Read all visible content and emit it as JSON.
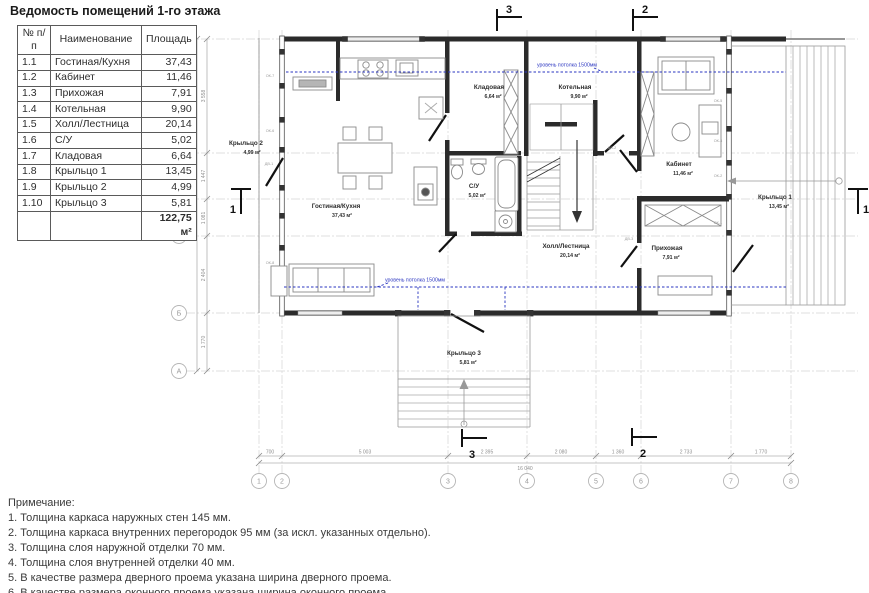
{
  "schedule": {
    "title": "Ведомость помещений 1-го этажа",
    "headers": {
      "num": "№ п/п",
      "name": "Наименование",
      "area": "Площадь"
    },
    "rows": [
      {
        "num": "1.1",
        "name": "Гостиная/Кухня",
        "area": "37,43"
      },
      {
        "num": "1.2",
        "name": "Кабинет",
        "area": "11,46"
      },
      {
        "num": "1.3",
        "name": "Прихожая",
        "area": "7,91"
      },
      {
        "num": "1.4",
        "name": "Котельная",
        "area": "9,90"
      },
      {
        "num": "1.5",
        "name": "Холл/Лестница",
        "area": "20,14"
      },
      {
        "num": "1.6",
        "name": "С/У",
        "area": "5,02"
      },
      {
        "num": "1.7",
        "name": "Кладовая",
        "area": "6,64"
      },
      {
        "num": "1.8",
        "name": "Крыльцо 1",
        "area": "13,45"
      },
      {
        "num": "1.9",
        "name": "Крыльцо 2",
        "area": "4,99"
      },
      {
        "num": "1.10",
        "name": "Крыльцо 3",
        "area": "5,81"
      }
    ],
    "total": "122,75 м²"
  },
  "plan": {
    "rooms": {
      "living": {
        "name": "Гостиная/Кухня",
        "area": "37,43 м²"
      },
      "storage": {
        "name": "Кладовая",
        "area": "6,64 м²"
      },
      "boiler": {
        "name": "Котельная",
        "area": "9,90 м²"
      },
      "wc": {
        "name": "С/У",
        "area": "5,02 м²"
      },
      "hall": {
        "name": "Холл/Лестница",
        "area": "20,14 м²"
      },
      "cabinet": {
        "name": "Кабинет",
        "area": "11,46 м²"
      },
      "entry": {
        "name": "Прихожая",
        "area": "7,91 м²"
      },
      "porch1": {
        "name": "Крыльцо 1",
        "area": "13,45 м²"
      },
      "porch2": {
        "name": "Крыльцо 2",
        "area": "4,99 м²"
      },
      "porch3": {
        "name": "Крыльцо 3",
        "area": "5,81 м²"
      }
    },
    "ceiling_label": "уровень потолка 1500мм",
    "sections": {
      "s1": "1",
      "s2": "2",
      "s3": "3"
    },
    "grid": {
      "columns": [
        "1",
        "2",
        "3",
        "4",
        "5",
        "6",
        "7",
        "8"
      ],
      "rows": [
        "Е",
        "Д",
        "Г",
        "В",
        "Б",
        "А"
      ]
    },
    "dims": {
      "bottom": [
        "700",
        "5 003",
        "2 395",
        "2 080",
        "1 360",
        "2 733",
        "1 770"
      ],
      "bottom_total": "16 040",
      "left": [
        "3 558",
        "1 447",
        "1 081",
        "2 404",
        "1 770"
      ],
      "left_total": "10 270"
    },
    "tags": [
      "ОК-7",
      "ОК-6",
      "ДВ-1",
      "ОК-8",
      "ОК-5",
      "ОК-4",
      "ОК-2",
      "ОК-1",
      "ДВ-2",
      "ДВ-3"
    ]
  },
  "notes": {
    "title": "Примечание:",
    "items": [
      "1. Толщина каркаса наружных стен 145 мм.",
      "2. Толщина каркаса внутренних перегородок 95 мм (за искл. указанных отдельно).",
      "3. Толщина слоя наружной отделки 70 мм.",
      "4. Толщина слоя внутренней отделки 40 мм.",
      "5. В качестве размера дверного проема указана ширина дверного проема.",
      "6. В качестве размера оконного проема указана ширина оконного проема."
    ]
  },
  "colors": {
    "blue": "#2a35c0",
    "wall": "#2b2b2b",
    "furniture": "#8a8a8a",
    "grid_line": "#d5d5d5",
    "dim_text": "#8f8f8f"
  }
}
